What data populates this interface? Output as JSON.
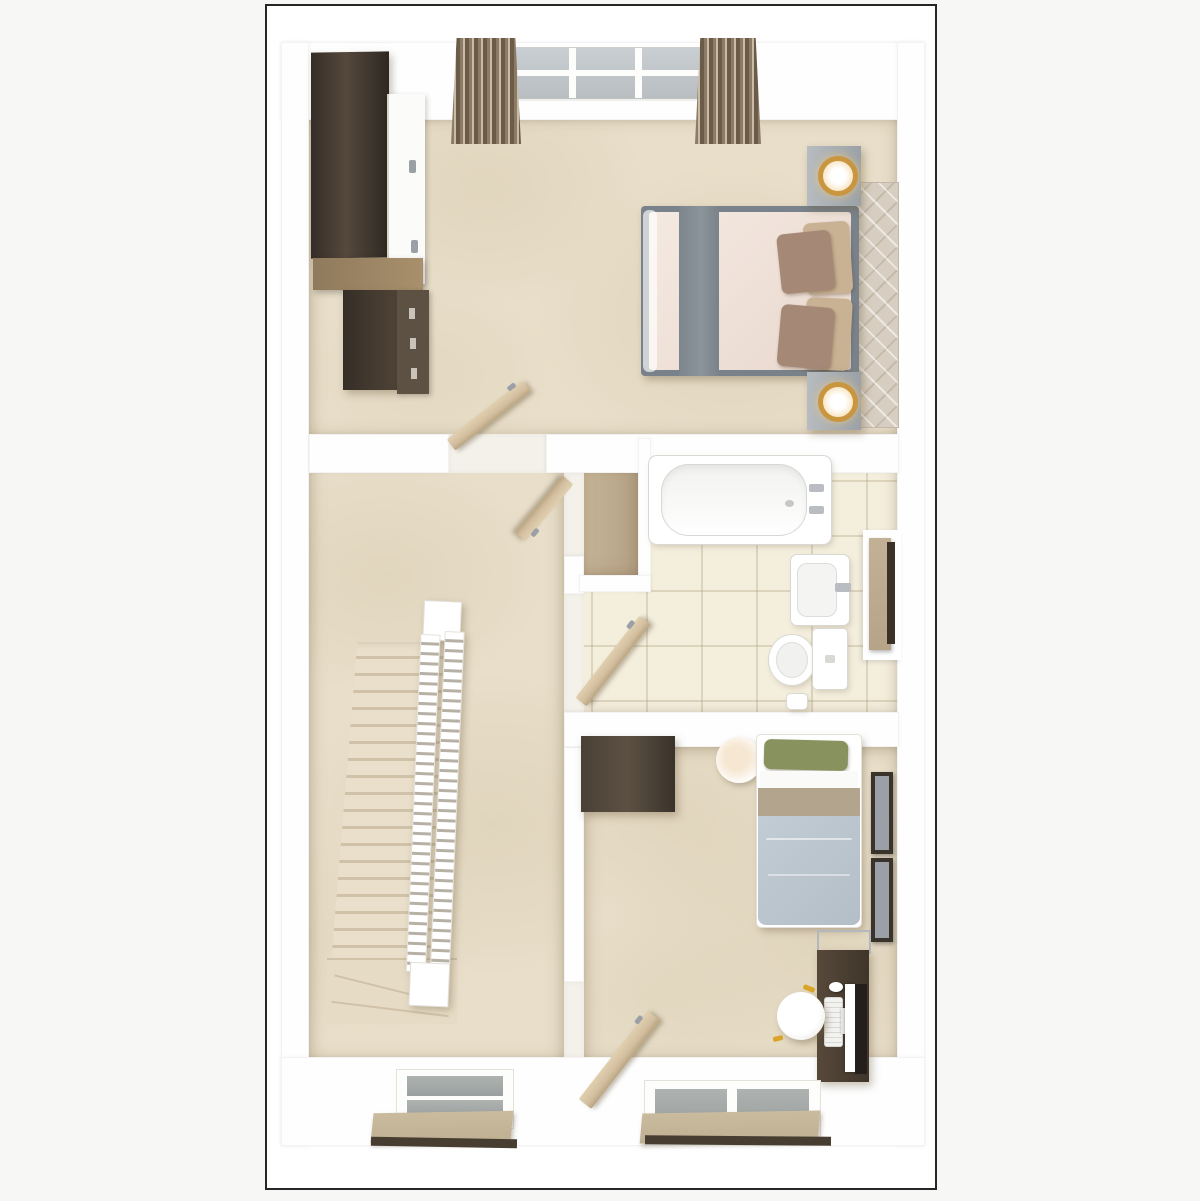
{
  "meta": {
    "description": "Top-down 3D dollhouse render of a first-floor plan; no text labels in image",
    "render": "photoreal 3D floor plan"
  },
  "palette": {
    "page_bg": "#f7f7f6",
    "matte": "#ffffff",
    "frame": "#262626",
    "wall": "#fefefe",
    "carpet": "#e8dec9",
    "tile": "#f4eedd",
    "cupboard_floor": "#c7b698",
    "wood_dark": "#4a4036",
    "wood_darker": "#2e2821",
    "wood_mid": "#a8906c",
    "door_wood": "#d3bfa0",
    "curtain_a": "#8d7b66",
    "curtain_b": "#cabba7",
    "curtain_c": "#6b5c4a",
    "glass": "#c9ced2",
    "bed_frame": "#79828a",
    "runner": "#8b939b",
    "duvet_a": "#f4e9e1",
    "duvet_b": "#e9d8ce",
    "headboard": "#d7cec1",
    "pillow_beige": "#c9b193",
    "pillow_mauve": "#a68876",
    "nightstand": "#9aa1a7",
    "lamp_gold": "#c9963f",
    "lamp_glow": "#f5d9a8",
    "fixture_line": "#d9d9d4",
    "radiator_tan": "#b7a488",
    "radiator_dark": "#3b3127",
    "stairs_a": "#e9dfca",
    "stairs_edge": "#cfc2a8",
    "railing_slot": "#b7b0a4",
    "blind_tan": "#c0b093",
    "blind_dark": "#473d31",
    "pillow_green": "#87925e",
    "band_taupe": "#b3a58d",
    "single_duvet": "#b4bec7",
    "desk_dark": "#3f352a",
    "desk_mid": "#57493a",
    "monitor_dark": "#241f1a",
    "accent_blue": "#44689d",
    "accent_yellow": "#d9a427",
    "metal": "#b4b8bc"
  },
  "rooms": [
    {
      "id": "double-bedroom",
      "label": "double bedroom",
      "objects": [
        "wardrobe",
        "chest-of-drawers",
        "window-with-curtains",
        "double-bed",
        "grey-bed-runner",
        "headboard",
        "nightstand-with-lamp-top",
        "nightstand-with-lamp-bottom",
        "open-door"
      ]
    },
    {
      "id": "landing",
      "label": "landing",
      "objects": [
        "staircase",
        "white-banister",
        "half-landing",
        "cupboard-open-door",
        "window-with-roller-blind"
      ]
    },
    {
      "id": "cupboard",
      "label": "storage cupboard",
      "objects": []
    },
    {
      "id": "bathroom",
      "label": "bathroom",
      "objects": [
        "bathtub-with-taps",
        "washbasin",
        "toilet",
        "toilet-brush",
        "wall-panel-radiator",
        "open-door"
      ]
    },
    {
      "id": "single-bedroom",
      "label": "single bedroom",
      "objects": [
        "dark-side-unit",
        "pendant-lamp",
        "single-bed",
        "picture-frames",
        "desk",
        "monitor",
        "keyboard",
        "mouse",
        "stool",
        "window-with-roller-blind",
        "open-door"
      ]
    }
  ]
}
